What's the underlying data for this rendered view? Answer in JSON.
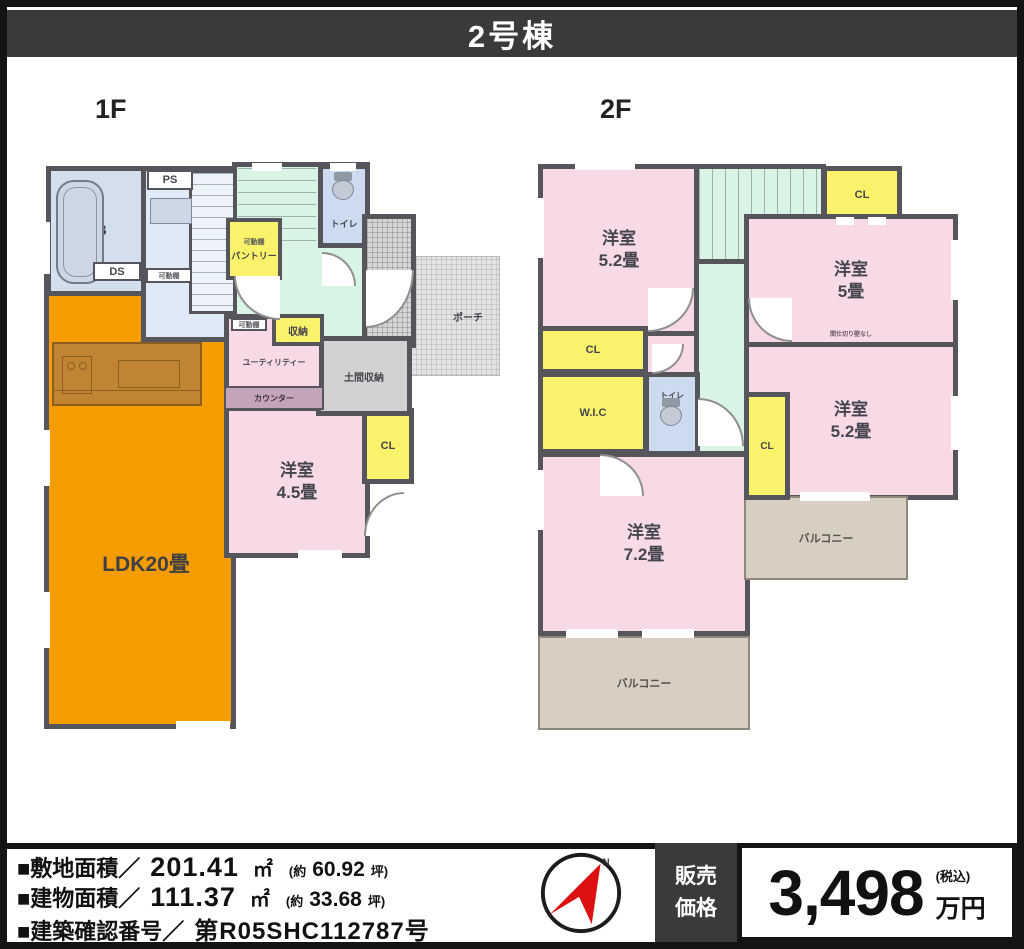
{
  "header": {
    "title": "2号棟"
  },
  "floor1": {
    "title": "1F",
    "ldk_label": "LDK20畳",
    "western_room": {
      "name": "洋室",
      "size": "4.5畳"
    },
    "labels": {
      "ub": "UB",
      "ps": "PS",
      "ds": "DS",
      "pantry": "パントリー",
      "toilet": "トイレ",
      "entrance": "玄関",
      "porch": "ポーチ",
      "storage": "収納",
      "utility": "ユーティリティー",
      "counter": "カウンター",
      "doma_storage": "土間収納",
      "closet": "CL",
      "movable_shelf": "可動棚"
    }
  },
  "floor2": {
    "title": "2F",
    "rooms": {
      "nw": {
        "name": "洋室",
        "size": "5.2畳"
      },
      "ne": {
        "name": "洋室",
        "size": "5畳"
      },
      "se": {
        "name": "洋室",
        "size": "5.2畳"
      },
      "sw": {
        "name": "洋室",
        "size": "7.2畳"
      }
    },
    "labels": {
      "closet": "CL",
      "wic": "W.I.C",
      "toilet": "トイレ",
      "balcony": "バルコニー",
      "partition_note": "間仕切り壁なし"
    }
  },
  "footer": {
    "site_area": {
      "label": "■敷地面積／",
      "value": "201.41",
      "unit": "㎡",
      "approx_prefix": "(約",
      "approx_value": "60.92",
      "approx_suffix": "坪)"
    },
    "building_area": {
      "label": "■建物面積／",
      "value": "111.37",
      "unit": "㎡",
      "approx_prefix": "(約",
      "approx_value": "33.68",
      "approx_suffix": "坪)"
    },
    "confirmation": {
      "label": "■建築確認番号／",
      "value": "第R05SHC112787号"
    },
    "compass_north": "N",
    "price": {
      "heading": "販売価格",
      "amount": "3,498",
      "tax_note": "(税込)",
      "unit": "万円"
    }
  },
  "palette": {
    "wall": "#55555b",
    "header_bg": "#3a3a3c",
    "ldk_orange": "#f49c00",
    "kitchen_brown": "#c08433",
    "room_pink": "#f8d9e6",
    "closet_yellow": "#faf26b",
    "hall_green": "#d9f3e4",
    "bath_blue": "#dce8f5",
    "storage_gray": "#d2d2d2",
    "balcony_beige": "#d8cfc2",
    "counter_mauve": "#c3a5b9",
    "compass_red": "#dd1111"
  }
}
